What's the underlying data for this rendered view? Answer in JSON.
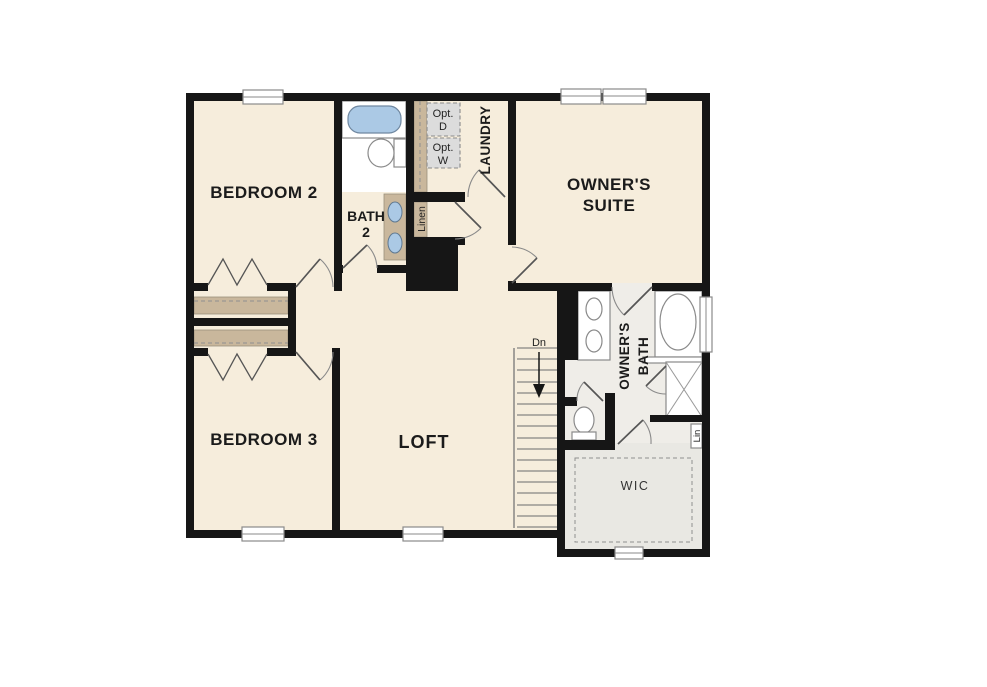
{
  "floorplan": {
    "rooms": {
      "bedroom2": {
        "label": "BEDROOM 2"
      },
      "bedroom3": {
        "label": "BEDROOM 3"
      },
      "loft": {
        "label": "LOFT"
      },
      "owners_suite": {
        "line1": "OWNER'S",
        "line2": "SUITE"
      },
      "bath2": {
        "line1": "BATH",
        "line2": "2"
      },
      "owners_bath": {
        "line1": "OWNER'S",
        "line2": "BATH"
      },
      "laundry": {
        "label": "LAUNDRY"
      },
      "wic": {
        "label": "WIC"
      },
      "linen_closet": {
        "label": "Linen"
      },
      "linen_cabinet": {
        "label": "Lin"
      }
    },
    "appliances": {
      "optional_dryer": {
        "line1": "Opt.",
        "line2": "D"
      },
      "optional_washer": {
        "line1": "Opt.",
        "line2": "W"
      }
    },
    "stairs": {
      "direction_label": "Dn"
    },
    "colors": {
      "floor_cream": "#f6eddc",
      "bath_floor": "#efede8",
      "wic_floor": "#e9e8e3",
      "wall_black": "#161616",
      "tub_blue": "#abc9e5",
      "cabinet_tan": "#c9b79c",
      "appliance_gray": "#dcdcdc"
    }
  }
}
